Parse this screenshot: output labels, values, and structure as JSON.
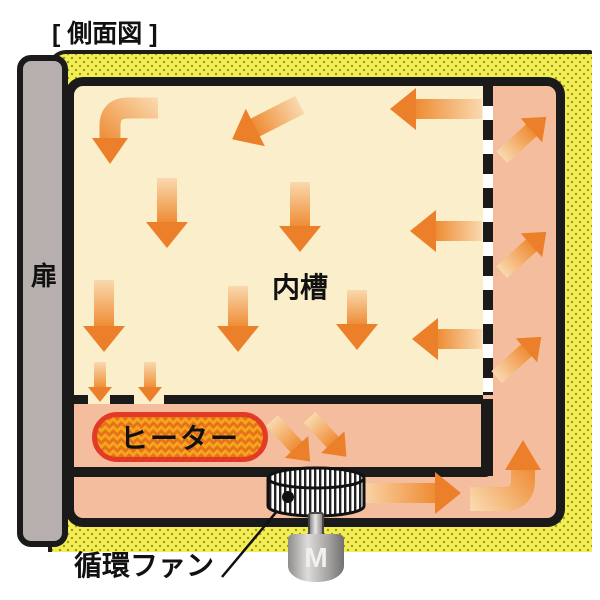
{
  "title": "[ 側面図 ]",
  "labels": {
    "door": "扉",
    "inner_chamber": "内槽",
    "heater": "ヒーター",
    "fan": "循環ファン",
    "motor": "M"
  },
  "colors": {
    "insulation_yellow": "#f2ee58",
    "insulation_dot": "#a89a10",
    "duct_pink": "#f4bd9e",
    "chamber_cream": "#faeecb",
    "arrow_orange": "#ec7f2a",
    "arrow_light": "#f9d9ae",
    "heater_fill": "#f7a41d",
    "heater_border": "#e23a26",
    "door_gray": "#b7afad",
    "outline_black": "#1a1a1a"
  },
  "arrows": {
    "sizes": {
      "lg": {
        "body": 20,
        "headW": 42,
        "headD": 26
      },
      "md": {
        "body": 16,
        "headW": 32,
        "headD": 20
      },
      "sm": {
        "body": 12,
        "headW": 24,
        "headD": 15
      }
    },
    "straight": [
      {
        "name": "chamber-downleft",
        "x": 266,
        "y": 122,
        "len": 76,
        "angle": 153,
        "size": "lg"
      },
      {
        "name": "chamber-left-1",
        "x": 436,
        "y": 109,
        "len": 92,
        "angle": 180,
        "size": "lg"
      },
      {
        "name": "chamber-down-1",
        "x": 167,
        "y": 213,
        "len": 70,
        "angle": 90,
        "size": "lg"
      },
      {
        "name": "chamber-down-2",
        "x": 300,
        "y": 217,
        "len": 70,
        "angle": 90,
        "size": "lg"
      },
      {
        "name": "chamber-left-2",
        "x": 446,
        "y": 231,
        "len": 72,
        "angle": 180,
        "size": "lg"
      },
      {
        "name": "chamber-down-3",
        "x": 104,
        "y": 316,
        "len": 72,
        "angle": 90,
        "size": "lg"
      },
      {
        "name": "chamber-down-4",
        "x": 238,
        "y": 319,
        "len": 66,
        "angle": 90,
        "size": "lg"
      },
      {
        "name": "chamber-down-5",
        "x": 357,
        "y": 320,
        "len": 60,
        "angle": 90,
        "size": "lg"
      },
      {
        "name": "chamber-left-3",
        "x": 447,
        "y": 339,
        "len": 70,
        "angle": 180,
        "size": "lg"
      },
      {
        "name": "vent-down-1",
        "x": 100,
        "y": 382,
        "len": 40,
        "angle": 90,
        "size": "sm"
      },
      {
        "name": "vent-down-2",
        "x": 150,
        "y": 382,
        "len": 40,
        "angle": 90,
        "size": "sm"
      },
      {
        "name": "duct-up-1",
        "x": 524,
        "y": 137,
        "len": 60,
        "angle": -42,
        "size": "md"
      },
      {
        "name": "duct-up-2",
        "x": 524,
        "y": 252,
        "len": 60,
        "angle": -42,
        "size": "md"
      },
      {
        "name": "duct-up-3",
        "x": 519,
        "y": 357,
        "len": 60,
        "angle": -42,
        "size": "md"
      },
      {
        "name": "heater-out-1",
        "x": 291,
        "y": 441,
        "len": 56,
        "angle": 47,
        "size": "md"
      },
      {
        "name": "heater-out-2",
        "x": 328,
        "y": 437,
        "len": 54,
        "angle": 47,
        "size": "md"
      },
      {
        "name": "duct-right",
        "x": 410,
        "y": 493,
        "len": 102,
        "angle": 0,
        "size": "lg"
      }
    ],
    "curved": [
      {
        "name": "chamber-bend-topleft",
        "path": "M158,108 L128,108 Q110,108 110,126 L110,140",
        "strokeW": 21,
        "head": "92,138 128,138 110,164",
        "grad": {
          "x1": 158,
          "y1": 100,
          "x2": 110,
          "y2": 152
        }
      },
      {
        "name": "duct-turn-bottomright",
        "path": "M470,499 L504,499 Q523,499 523,480 L523,470",
        "strokeW": 24,
        "head": "505,470 541,470 523,440",
        "grad": {
          "x1": 466,
          "y1": 499,
          "x2": 523,
          "y2": 452
        }
      }
    ],
    "pointer_line": {
      "x1": 222,
      "y1": 577,
      "x2": 288,
      "y2": 498
    }
  }
}
